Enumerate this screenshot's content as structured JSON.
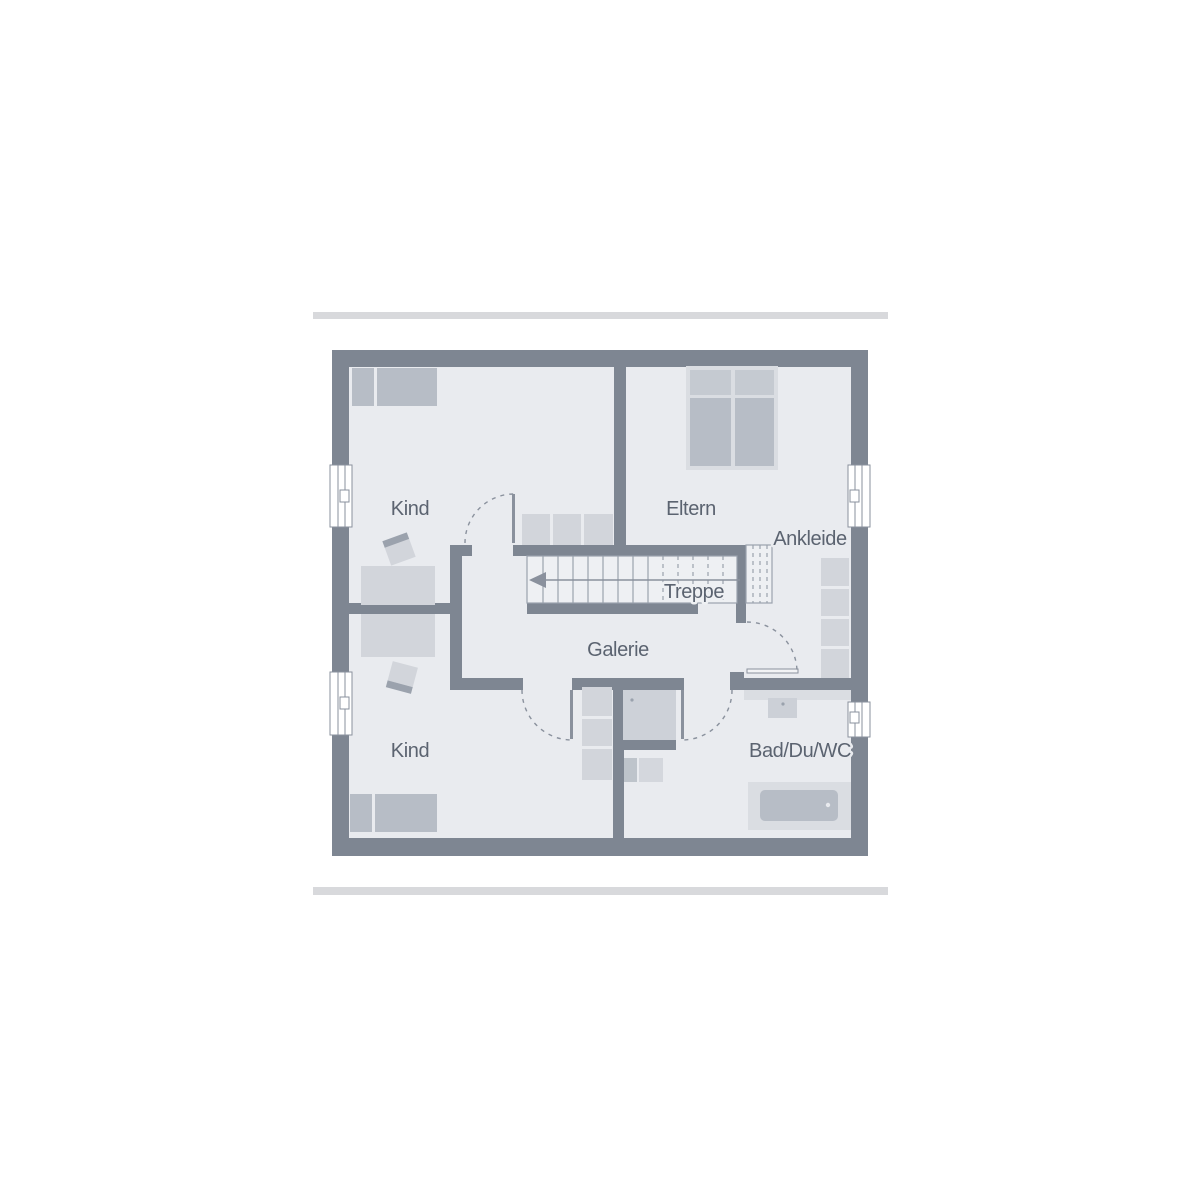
{
  "rooms": {
    "kind_top": {
      "label": "Kind"
    },
    "kind_bottom": {
      "label": "Kind"
    },
    "eltern": {
      "label": "Eltern"
    },
    "ankleide": {
      "label": "Ankleide"
    },
    "treppe": {
      "label": "Treppe"
    },
    "galerie": {
      "label": "Galerie"
    },
    "bad": {
      "label": "Bad/Du/WC"
    }
  },
  "stairs": {
    "direction_arrow": "left"
  },
  "colors": {
    "background": "#ffffff",
    "bar": "#d8d9dc",
    "wall": "#7e8692",
    "floor": "#e9ebef",
    "stair_floor": "#eef0f3",
    "furniture": "#d2d5db",
    "furniture_dark": "#b7bdc6",
    "pillow": "#c5cad1",
    "frame": "#dadde2",
    "line": "#9aa2ad",
    "door": "#8a919d",
    "text": "#5b6370"
  }
}
